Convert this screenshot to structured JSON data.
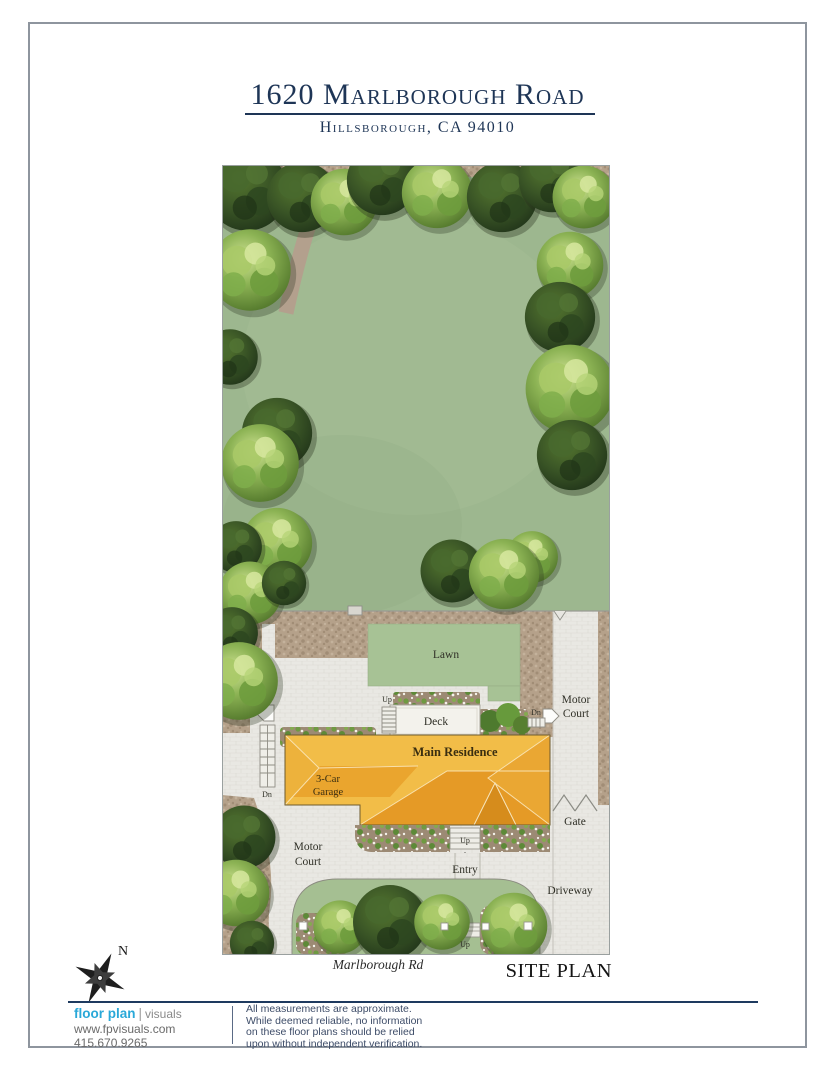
{
  "header": {
    "title": "1620 Marlborough Road",
    "subtitle": "Hillsborough, CA 94010"
  },
  "site_plan": {
    "labels": {
      "lawn": "Lawn",
      "deck": "Deck",
      "main_residence": "Main Residence",
      "garage_line1": "3-Car",
      "garage_line2": "Garage",
      "motor": "Motor",
      "court": "Court",
      "gate": "Gate",
      "driveway": "Driveway",
      "entry": "Entry",
      "up": "Up",
      "dn": "Dn"
    },
    "street": "Marlborough Rd",
    "caption": "SITE PLAN",
    "compass_north": "N"
  },
  "footer": {
    "logo_primary": "floor plan",
    "logo_secondary": "visuals",
    "website": "www.fpvisuals.com",
    "phone": "415.670.9265",
    "disclaimer_lines": [
      "All measurements are approximate.",
      "While deemed reliable, no information",
      "on these floor plans should be relied",
      "upon without independent verification."
    ]
  },
  "colors": {
    "navy": "#1e3556",
    "logo_cyan": "#29a8d8",
    "roof_light": "#f2bd48",
    "roof_mid": "#eaa52e",
    "roof_dark": "#e59a26",
    "backyard_grass": "#9db78f",
    "lawn_green": "#a7c295",
    "paver_gray": "#e9e8e3",
    "dirt_tan": "#b5a18a"
  }
}
